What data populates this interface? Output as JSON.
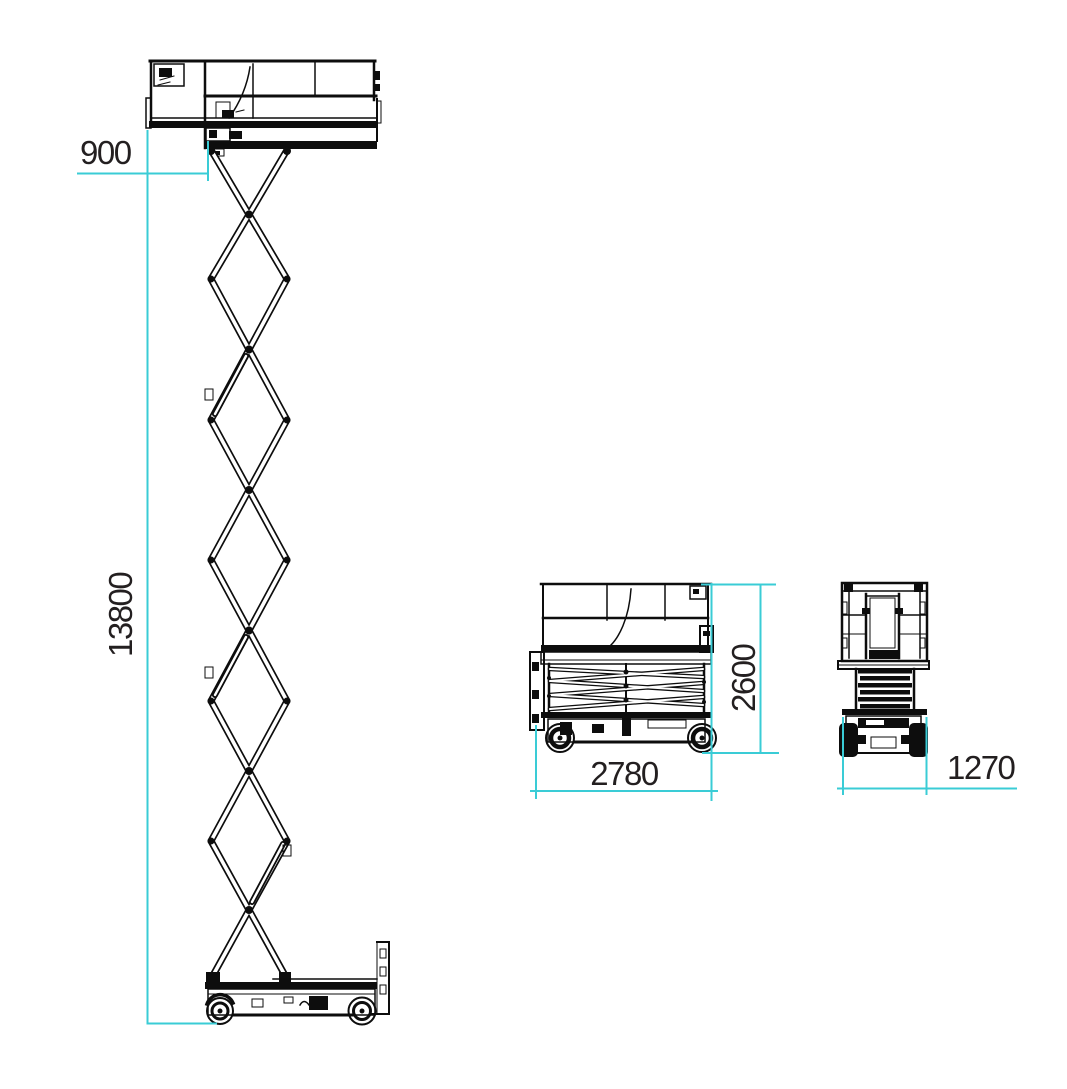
{
  "colors": {
    "dimension_accent": "#3accd6",
    "ink": "#0d0d0d",
    "background": "#ffffff"
  },
  "dimension_labels": {
    "platform_extension": "900",
    "extended_height": "13800",
    "stowed_length": "2780",
    "stowed_height": "2600",
    "overall_width": "1270"
  }
}
